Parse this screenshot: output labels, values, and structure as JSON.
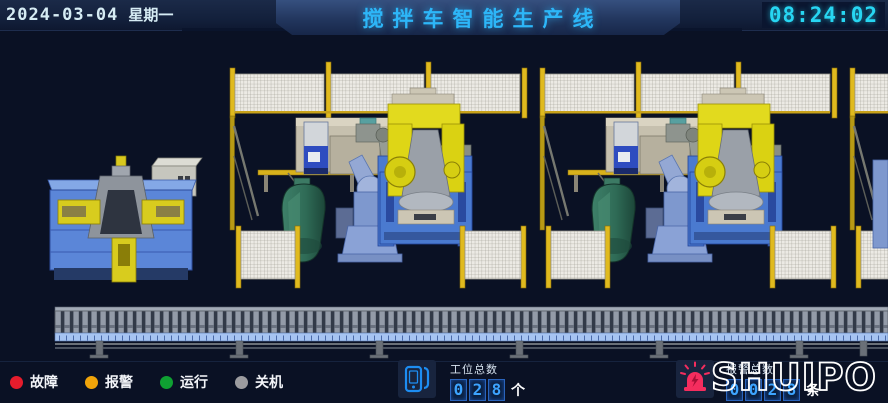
{
  "header": {
    "date": "2024-03-04",
    "weekday": "星期一",
    "title": "搅拌车智能生产线",
    "time": "08:24:02"
  },
  "legend": {
    "items": [
      {
        "label": "故障",
        "color": "#e51c2c"
      },
      {
        "label": "报警",
        "color": "#f0a40a"
      },
      {
        "label": "运行",
        "color": "#0fa032"
      },
      {
        "label": "关机",
        "color": "#9c9ca0"
      }
    ]
  },
  "station_counter": {
    "label": "工位总数",
    "digits": [
      "0",
      "2",
      "8"
    ],
    "unit": "个"
  },
  "alarm_counter": {
    "label": "报警总数",
    "digits": [
      "0",
      "0",
      "2",
      "8"
    ],
    "unit": "条"
  },
  "logo": {
    "text": "SHUIPO"
  },
  "icons": {
    "station": "hmi-panel-icon",
    "alarm": "alarm-beacon-icon"
  },
  "scene": {
    "colors": {
      "background": "#0a1124",
      "fence_yellow": "#e0ba1e",
      "mesh_white": "#eceae4",
      "positioner_yellow": "#ded616",
      "machine_base_blue": "#4a7ad0",
      "fixture_table_blue": "#5b86d8",
      "drum_green": "#2f6b56",
      "conveyor_gray": "#939ba8",
      "conveyor_rail_blue": "#a6c4f2",
      "robot_gray": "#9aa098",
      "platform_beige": "#c6c0ae"
    },
    "components": [
      "fixture-station",
      "control-cabinet",
      "welding-cell",
      "kuka-robot",
      "positioner",
      "mixer-drum-section",
      "floor-robot",
      "safety-fence",
      "conveyor-line"
    ]
  }
}
